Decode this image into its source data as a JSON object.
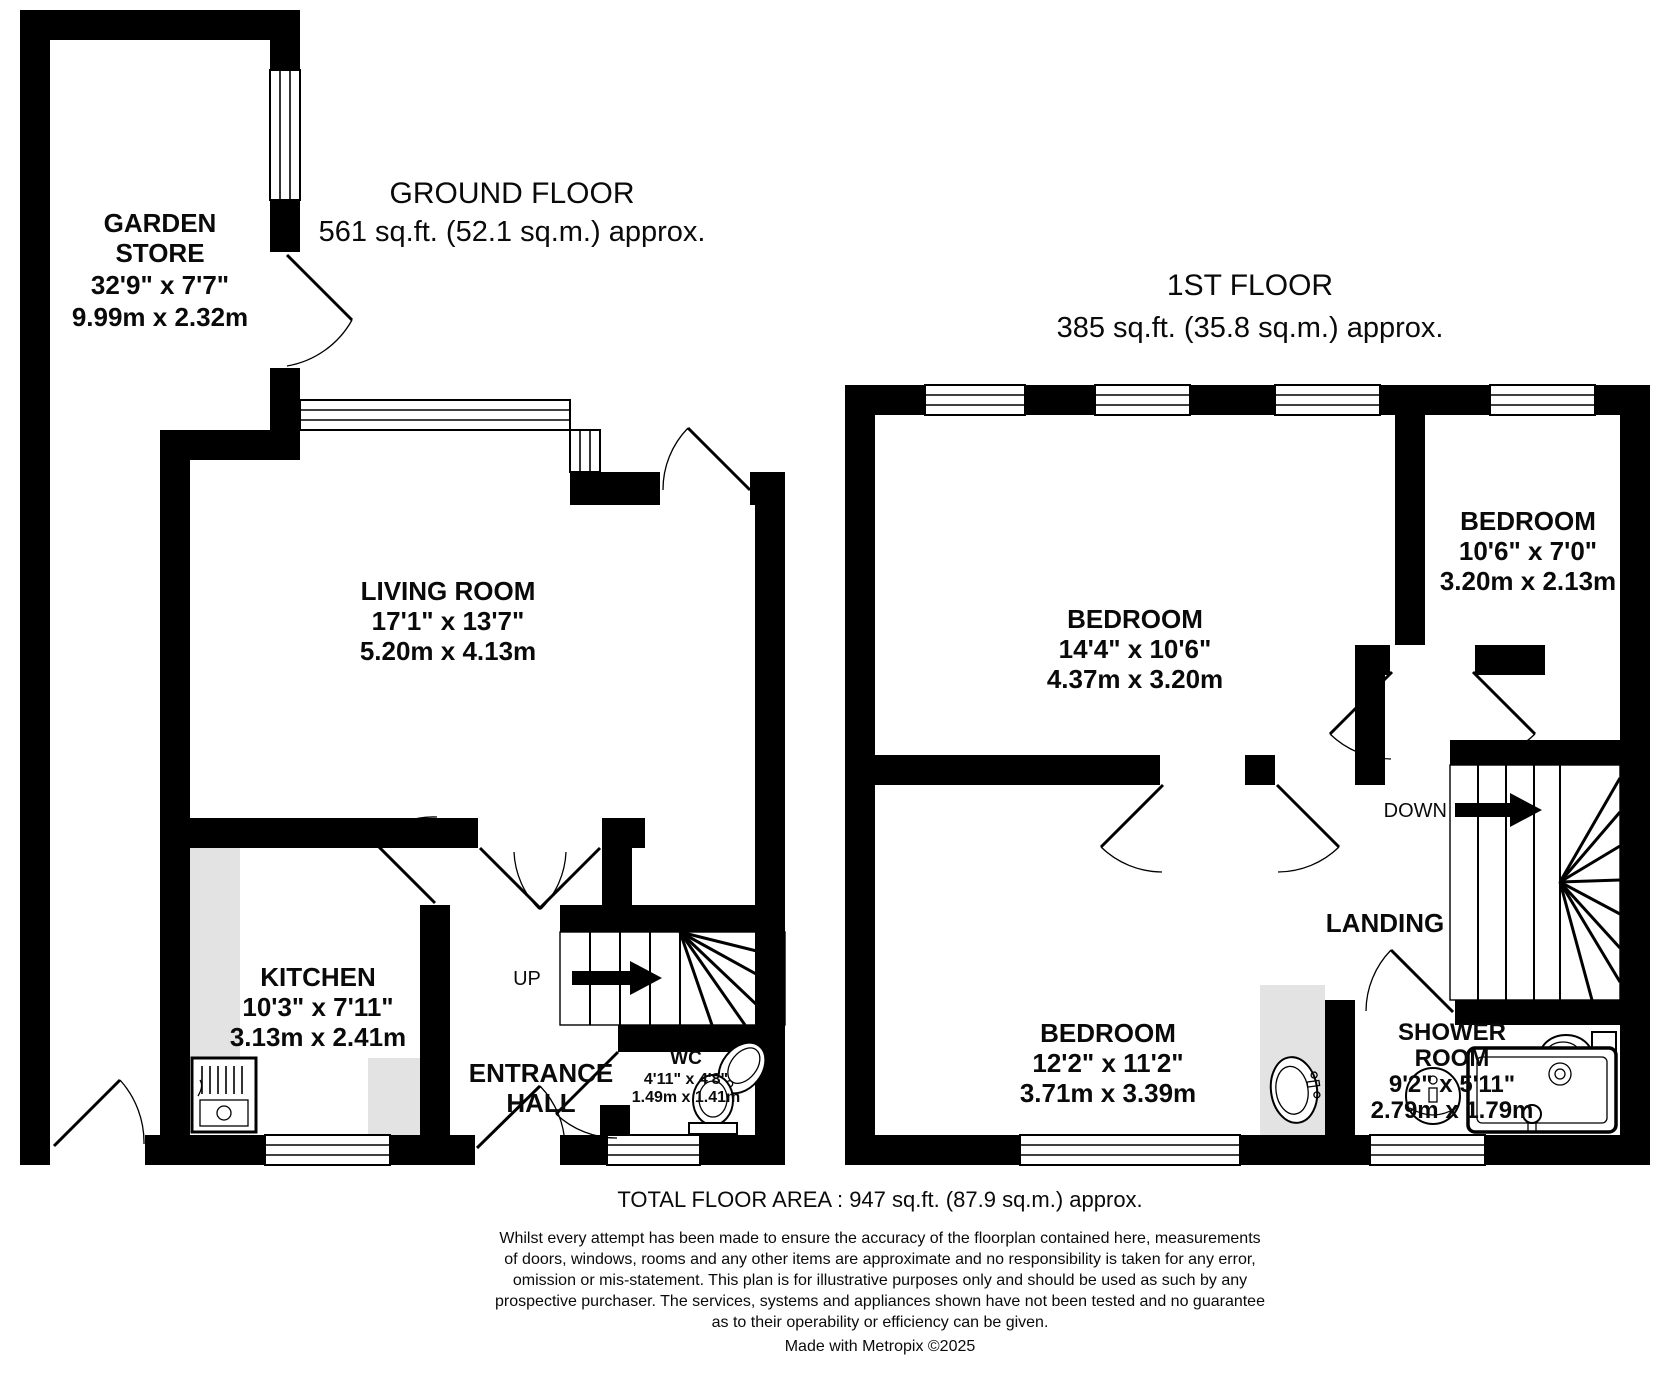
{
  "ground_floor": {
    "title": "GROUND FLOOR",
    "area": "561 sq.ft. (52.1 sq.m.) approx.",
    "garden_store": {
      "name1": "GARDEN",
      "name2": "STORE",
      "imperial": "32'9\"  x 7'7\"",
      "metric": "9.99m  x 2.32m"
    },
    "living_room": {
      "name": "LIVING ROOM",
      "imperial": "17'1\"  x 13'7\"",
      "metric": "5.20m  x 4.13m"
    },
    "kitchen": {
      "name": "KITCHEN",
      "imperial": "10'3\"  x 7'11\"",
      "metric": "3.13m  x 2.41m"
    },
    "entrance_hall": {
      "name1": "ENTRANCE",
      "name2": "HALL"
    },
    "wc": {
      "name": "WC",
      "imperial": "4'11\"  x 4'8\"",
      "metric": "1.49m  x 1.41m"
    },
    "stairs": {
      "label": "UP"
    }
  },
  "first_floor": {
    "title": "1ST FLOOR",
    "area": "385 sq.ft. (35.8 sq.m.) approx.",
    "bedroom_large": {
      "name": "BEDROOM",
      "imperial": "14'4\"  x 10'6\"",
      "metric": "4.37m  x 3.20m"
    },
    "bedroom_small": {
      "name": "BEDROOM",
      "imperial": "10'6\"  x 7'0\"",
      "metric": "3.20m  x 2.13m"
    },
    "bedroom_mid": {
      "name": "BEDROOM",
      "imperial": "12'2\"  x 11'2\"",
      "metric": "3.71m  x 3.39m"
    },
    "landing": {
      "name": "LANDING"
    },
    "shower_room": {
      "name1": "SHOWER",
      "name2": "ROOM",
      "imperial": "9'2\"  x 5'11\"",
      "metric": "2.79m  x 1.79m"
    },
    "stairs": {
      "label": "DOWN"
    }
  },
  "footer": {
    "total": "TOTAL FLOOR AREA : 947 sq.ft. (87.9 sq.m.) approx.",
    "disclaimer1": "Whilst every attempt has been made to ensure the accuracy of the floorplan contained here, measurements",
    "disclaimer2": "of doors, windows, rooms and any other items are approximate and no responsibility is taken for any error,",
    "disclaimer3": "omission or mis-statement. This plan is for illustrative purposes only and should be used as such by any",
    "disclaimer4": "prospective purchaser. The services, systems and appliances shown have not been tested and no guarantee",
    "disclaimer5": "as to their operability or efficiency can be given.",
    "credit": "Made with Metropix ©2025"
  },
  "colors": {
    "wall": "#000000",
    "counter": "#e3e3e3",
    "background": "#ffffff"
  }
}
